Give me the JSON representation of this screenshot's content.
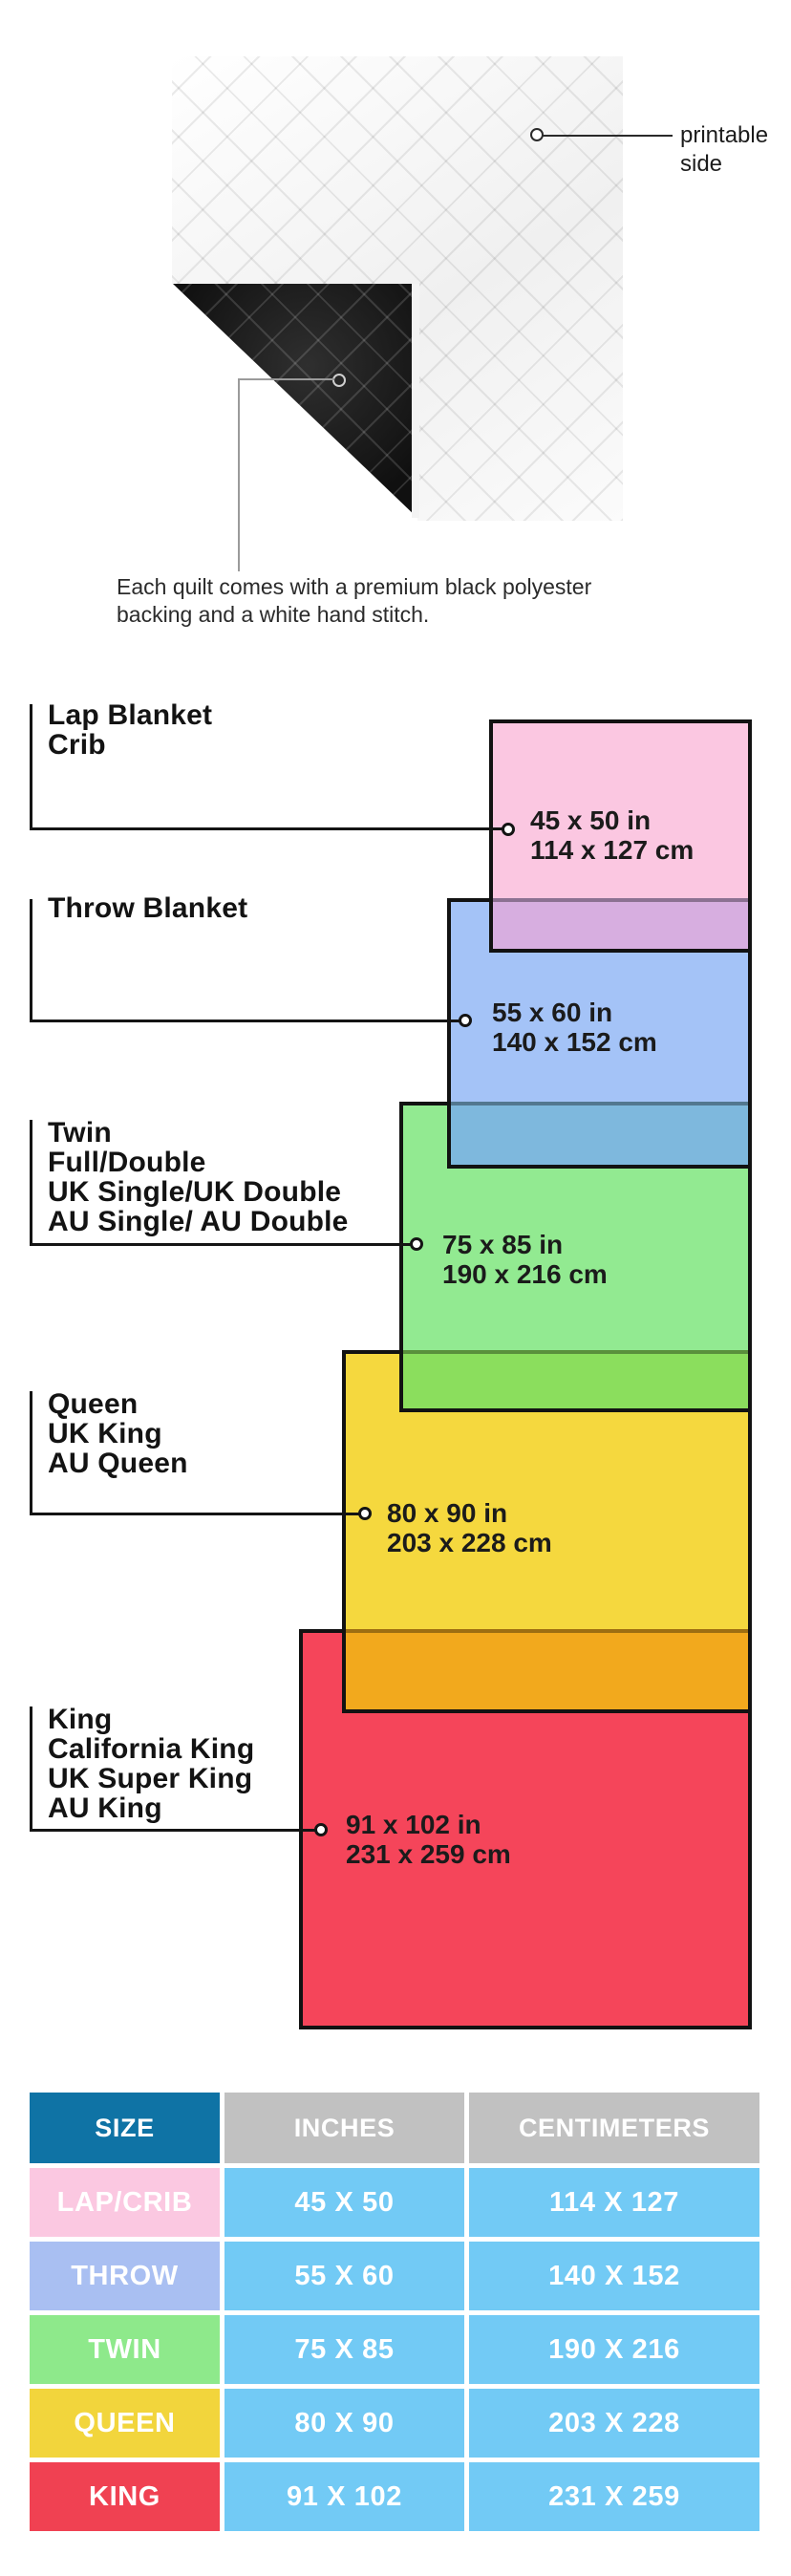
{
  "quilt": {
    "printable_label": "printable side",
    "description": "Each quilt comes with a premium black polyester\nbacking and a white hand stitch."
  },
  "diagram": {
    "items": [
      {
        "label": "Lap Blanket\nCrib",
        "size_in": "45 x 50 in",
        "size_cm": "114 x 127 cm",
        "fill": "#FBC7E1",
        "overlap_fill": "#D7AEE0"
      },
      {
        "label": "Throw Blanket",
        "size_in": "55 x 60 in",
        "size_cm": "140 x 152 cm",
        "fill": "#A4C3F7",
        "overlap_fill": "#7EB8DD"
      },
      {
        "label": "Twin\nFull/Double\nUK Single/UK Double\nAU Single/ AU Double",
        "size_in": "75 x 85 in",
        "size_cm": "190 x 216 cm",
        "fill": "#92EA91",
        "overlap_fill": "#8BDE5D"
      },
      {
        "label": "Queen\nUK King\nAU Queen",
        "size_in": "80 x 90 in",
        "size_cm": "203 x 228 cm",
        "fill": "#F5D83E",
        "overlap_fill": "#F2A91D"
      },
      {
        "label": "King\nCalifornia King\nUK Super King\nAU King",
        "size_in": "91 x 102 in",
        "size_cm": "231 x 259 cm",
        "fill": "#F5455A",
        "overlap_fill": null
      }
    ]
  },
  "table": {
    "headers": [
      "SIZE",
      "INCHES",
      "CENTIMETERS"
    ],
    "header_colors": {
      "size": "#0F73A5",
      "other": "#C1C1C1"
    },
    "value_cell_color": "#72CAF5",
    "rows": [
      {
        "size": "LAP/CRIB",
        "inches": "45 X 50",
        "cm": "114 X 127",
        "color": "#FBC8E1"
      },
      {
        "size": "THROW",
        "inches": "55 X 60",
        "cm": "140 X 152",
        "color": "#A9BFF2"
      },
      {
        "size": "TWIN",
        "inches": "75 X 85",
        "cm": "190 X 216",
        "color": "#8EE98B"
      },
      {
        "size": "QUEEN",
        "inches": "80 X 90",
        "cm": "203 X 228",
        "color": "#F2D53C"
      },
      {
        "size": "KING",
        "inches": "91 X 102",
        "cm": "231 X 259",
        "color": "#F04152"
      }
    ]
  }
}
